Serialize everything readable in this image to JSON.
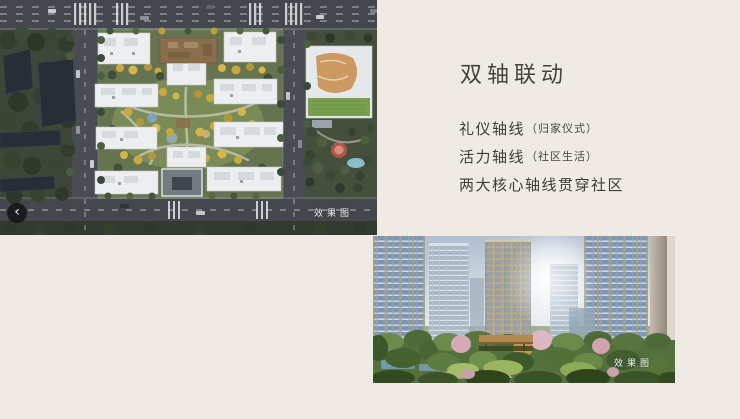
{
  "page": {
    "background_color": "#efeae4",
    "text_color": "#413d38"
  },
  "text_panel": {
    "title": "双轴联动",
    "lines": [
      {
        "main": "礼仪轴线",
        "sub": "（归家仪式）"
      },
      {
        "main": "活力轴线",
        "sub": "（社区生活）"
      },
      {
        "main": "两大核心轴线贯穿社区",
        "sub": ""
      }
    ]
  },
  "carousel": {
    "prev_label": "‹"
  },
  "images": {
    "aerial": {
      "watermark": "效果图"
    },
    "street": {
      "watermark": "效果图"
    }
  }
}
